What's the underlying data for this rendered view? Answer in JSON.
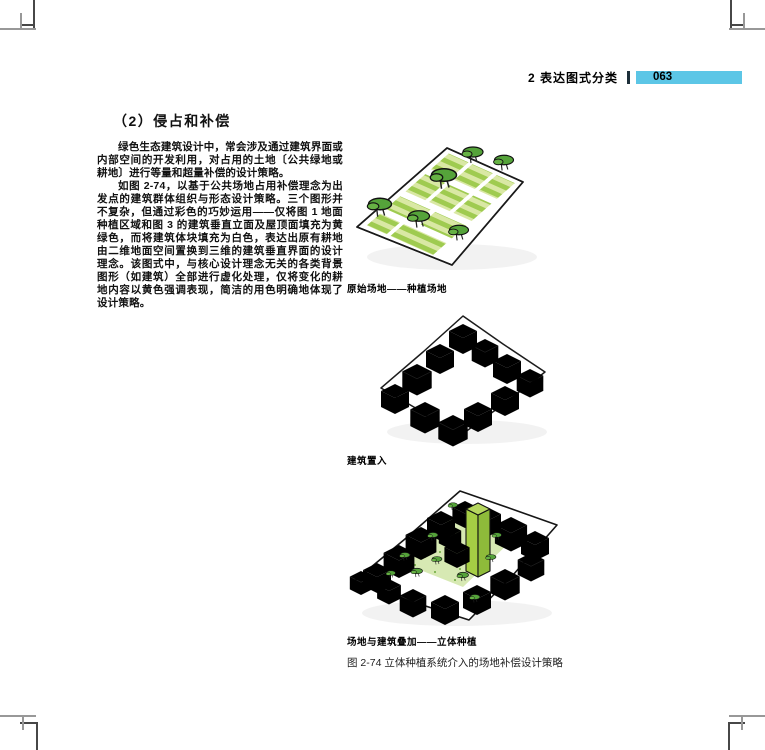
{
  "page": {
    "header": {
      "chapter": "2 表达图式分类",
      "page_number": "063",
      "accent_color": "#5CC6E6"
    },
    "article": {
      "heading": "（2）侵占和补偿",
      "paragraphs": [
        "绿色生态建筑设计中，常会涉及通过建筑界面或内部空间的开发利用，对占用的土地〔公共绿地或耕地〕进行等量和超量补偿的设计策略。",
        "如图 2-74，以基于公共场地占用补偿理念为出发点的建筑群体组织与形态设计策略。三个图形并不复杂，但通过彩色的巧妙运用——仅将图 1 地面种植区域和图 3 的建筑垂直立面及屋顶面填充为黄绿色，而将建筑体块填充为白色，表达出原有耕地由二维地面空间置换到三维的建筑垂直界面的设计理念。该图式中，与核心设计理念无关的各类背景图形（如建筑）全部进行虚化处理，仅将变化的耕地内容以黄色强调表现，简洁的用色明确地体现了设计策略。"
      ]
    },
    "figures": [
      {
        "caption": "原始场地——种植场地"
      },
      {
        "caption": "建筑置入"
      },
      {
        "caption": "场地与建筑叠加——立体种植"
      }
    ],
    "figure_caption": "图 2-74  立体种植系统介入的场地补偿设计策略",
    "colors": {
      "field_green": "#9FCB50",
      "field_green_light": "#D9E8A4",
      "tree_green": "#55A33A",
      "roof_green": "#DCE9BA",
      "tower_green": "#A6CE44"
    }
  }
}
